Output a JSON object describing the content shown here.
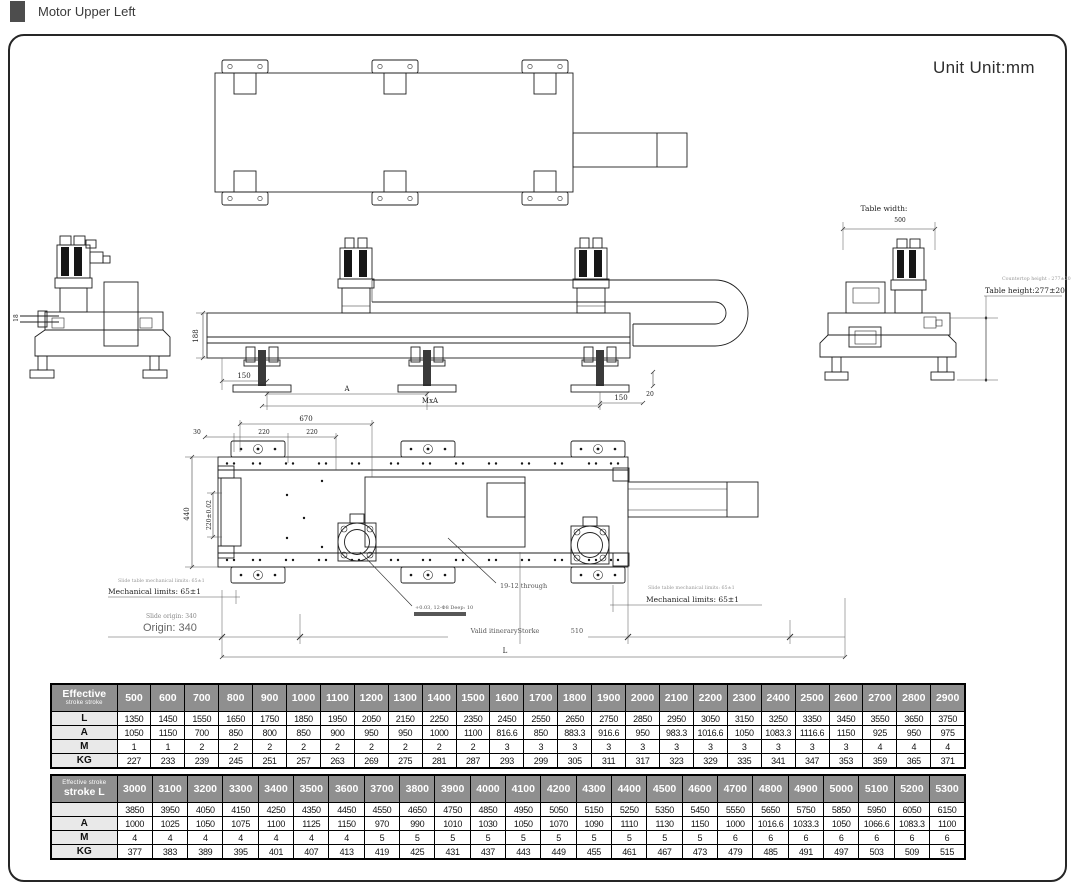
{
  "page": {
    "title": "Motor Upper Left",
    "unit_label": "Unit Unit:mm"
  },
  "drawing": {
    "left_view": {
      "shaft_dim": "18"
    },
    "elevation": {
      "height_dim": "188",
      "left_offset_dim": "150",
      "pitch_dim": "A",
      "span_dim": "MxA",
      "right_offset_dim": "150",
      "step_dim": "20"
    },
    "end_view": {
      "table_width_label": "Table width:",
      "table_width_value": "500",
      "countertop_note": "Countertop height : 277±20",
      "table_height_label": "Table height:277±20"
    },
    "bottom_view": {
      "total_top_dim": "670",
      "edge_dim": "30",
      "hole_pitch_dim_1": "220",
      "hole_pitch_dim_2": "220",
      "width_dim": "440",
      "slot_dim": "220±0.02",
      "through_holes_note": "19-12 through",
      "pin_holes_note": "+0.03, 12-Φ8 Deep: 10",
      "slide_limits_note_left": "Slide table mechanical limits: 65±1",
      "mechanical_limits_left": "Mechanical limits: 65±1",
      "slide_origin_note": "Slide origin: 340",
      "origin_label": "Origin: 340",
      "slide_limits_note_right": "Slide table mechanical limits: 65±1",
      "mechanical_limits_right": "Mechanical limits: 65±1",
      "valid_stroke_label": "Valid itineraryStorke",
      "right_span_dim": "510",
      "total_length_dim": "L"
    }
  },
  "table1": {
    "header_line1": "Effective",
    "header_line2": "stroke stroke",
    "columns": [
      "500",
      "600",
      "700",
      "800",
      "900",
      "1000",
      "1100",
      "1200",
      "1300",
      "1400",
      "1500",
      "1600",
      "1700",
      "1800",
      "1900",
      "2000",
      "2100",
      "2200",
      "2300",
      "2400",
      "2500",
      "2600",
      "2700",
      "2800",
      "2900"
    ],
    "rows": [
      {
        "label": "L",
        "values": [
          "1350",
          "1450",
          "1550",
          "1650",
          "1750",
          "1850",
          "1950",
          "2050",
          "2150",
          "2250",
          "2350",
          "2450",
          "2550",
          "2650",
          "2750",
          "2850",
          "2950",
          "3050",
          "3150",
          "3250",
          "3350",
          "3450",
          "3550",
          "3650",
          "3750"
        ]
      },
      {
        "label": "A",
        "values": [
          "1050",
          "1150",
          "700",
          "850",
          "800",
          "850",
          "900",
          "950",
          "950",
          "1000",
          "1100",
          "816.6",
          "850",
          "883.3",
          "916.6",
          "950",
          "983.3",
          "1016.6",
          "1050",
          "1083.3",
          "1116.6",
          "1150",
          "925",
          "950",
          "975"
        ]
      },
      {
        "label": "M",
        "values": [
          "1",
          "1",
          "2",
          "2",
          "2",
          "2",
          "2",
          "2",
          "2",
          "2",
          "2",
          "3",
          "3",
          "3",
          "3",
          "3",
          "3",
          "3",
          "3",
          "3",
          "3",
          "3",
          "4",
          "4",
          "4"
        ]
      },
      {
        "label": "KG",
        "values": [
          "227",
          "233",
          "239",
          "245",
          "251",
          "257",
          "263",
          "269",
          "275",
          "281",
          "287",
          "293",
          "299",
          "305",
          "311",
          "317",
          "323",
          "329",
          "335",
          "341",
          "347",
          "353",
          "359",
          "365",
          "371"
        ]
      }
    ]
  },
  "table2": {
    "header_line1": "Effective stroke",
    "header_line2": "stroke L",
    "columns": [
      "3000",
      "3100",
      "3200",
      "3300",
      "3400",
      "3500",
      "3600",
      "3700",
      "3800",
      "3900",
      "4000",
      "4100",
      "4200",
      "4300",
      "4400",
      "4500",
      "4600",
      "4700",
      "4800",
      "4900",
      "5000",
      "5100",
      "5200",
      "5300"
    ],
    "rows": [
      {
        "label": "",
        "values": [
          "3850",
          "3950",
          "4050",
          "4150",
          "4250",
          "4350",
          "4450",
          "4550",
          "4650",
          "4750",
          "4850",
          "4950",
          "5050",
          "5150",
          "5250",
          "5350",
          "5450",
          "5550",
          "5650",
          "5750",
          "5850",
          "5950",
          "6050",
          "6150"
        ]
      },
      {
        "label": "A",
        "values": [
          "1000",
          "1025",
          "1050",
          "1075",
          "1100",
          "1125",
          "1150",
          "970",
          "990",
          "1010",
          "1030",
          "1050",
          "1070",
          "1090",
          "1110",
          "1130",
          "1150",
          "1000",
          "1016.6",
          "1033.3",
          "1050",
          "1066.6",
          "1083.3",
          "1100"
        ]
      },
      {
        "label": "M",
        "values": [
          "4",
          "4",
          "4",
          "4",
          "4",
          "4",
          "4",
          "5",
          "5",
          "5",
          "5",
          "5",
          "5",
          "5",
          "5",
          "5",
          "5",
          "6",
          "6",
          "6",
          "6",
          "6",
          "6",
          "6"
        ]
      },
      {
        "label": "KG",
        "values": [
          "377",
          "383",
          "389",
          "395",
          "401",
          "407",
          "413",
          "419",
          "425",
          "431",
          "437",
          "443",
          "449",
          "455",
          "461",
          "467",
          "473",
          "479",
          "485",
          "491",
          "497",
          "503",
          "509",
          "515"
        ]
      }
    ]
  }
}
